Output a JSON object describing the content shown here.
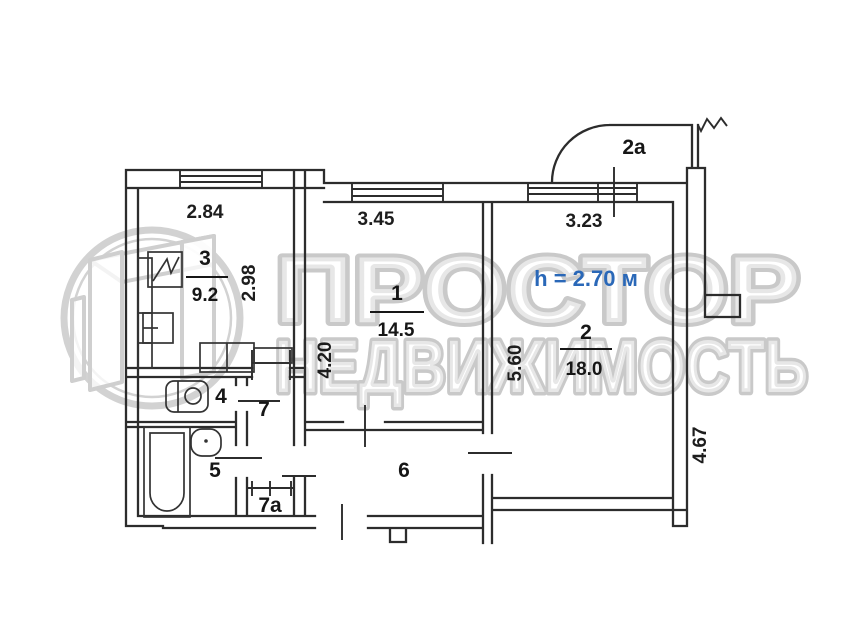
{
  "watermark": {
    "brand_line1": "ПРОСТОР",
    "brand_line2": "НЕДВИЖИМОСТЬ"
  },
  "plan": {
    "ceiling_height_label": "h = 2.70 м",
    "rooms": {
      "room1": {
        "number": "1",
        "area": "14.5"
      },
      "room2": {
        "number": "2",
        "area": "18.0"
      },
      "room3": {
        "number": "3",
        "area": "9.2"
      },
      "room4": {
        "number": "4"
      },
      "room5": {
        "number": "5"
      },
      "room6": {
        "number": "6"
      },
      "room7": {
        "number": "7"
      },
      "room7a": {
        "number": "7a"
      },
      "balcony": {
        "number": "2a"
      }
    },
    "dimensions": {
      "kitchen_width": "2.84",
      "kitchen_depth": "2.98",
      "room1_width": "3.45",
      "room1_depth": "4.20",
      "room2_width": "3.23",
      "room2_depth": "5.60",
      "right_side": "4.67"
    },
    "colors": {
      "wall": "#2c2c2c",
      "height_text": "#2a68b8",
      "watermark": "#cccccc"
    }
  }
}
